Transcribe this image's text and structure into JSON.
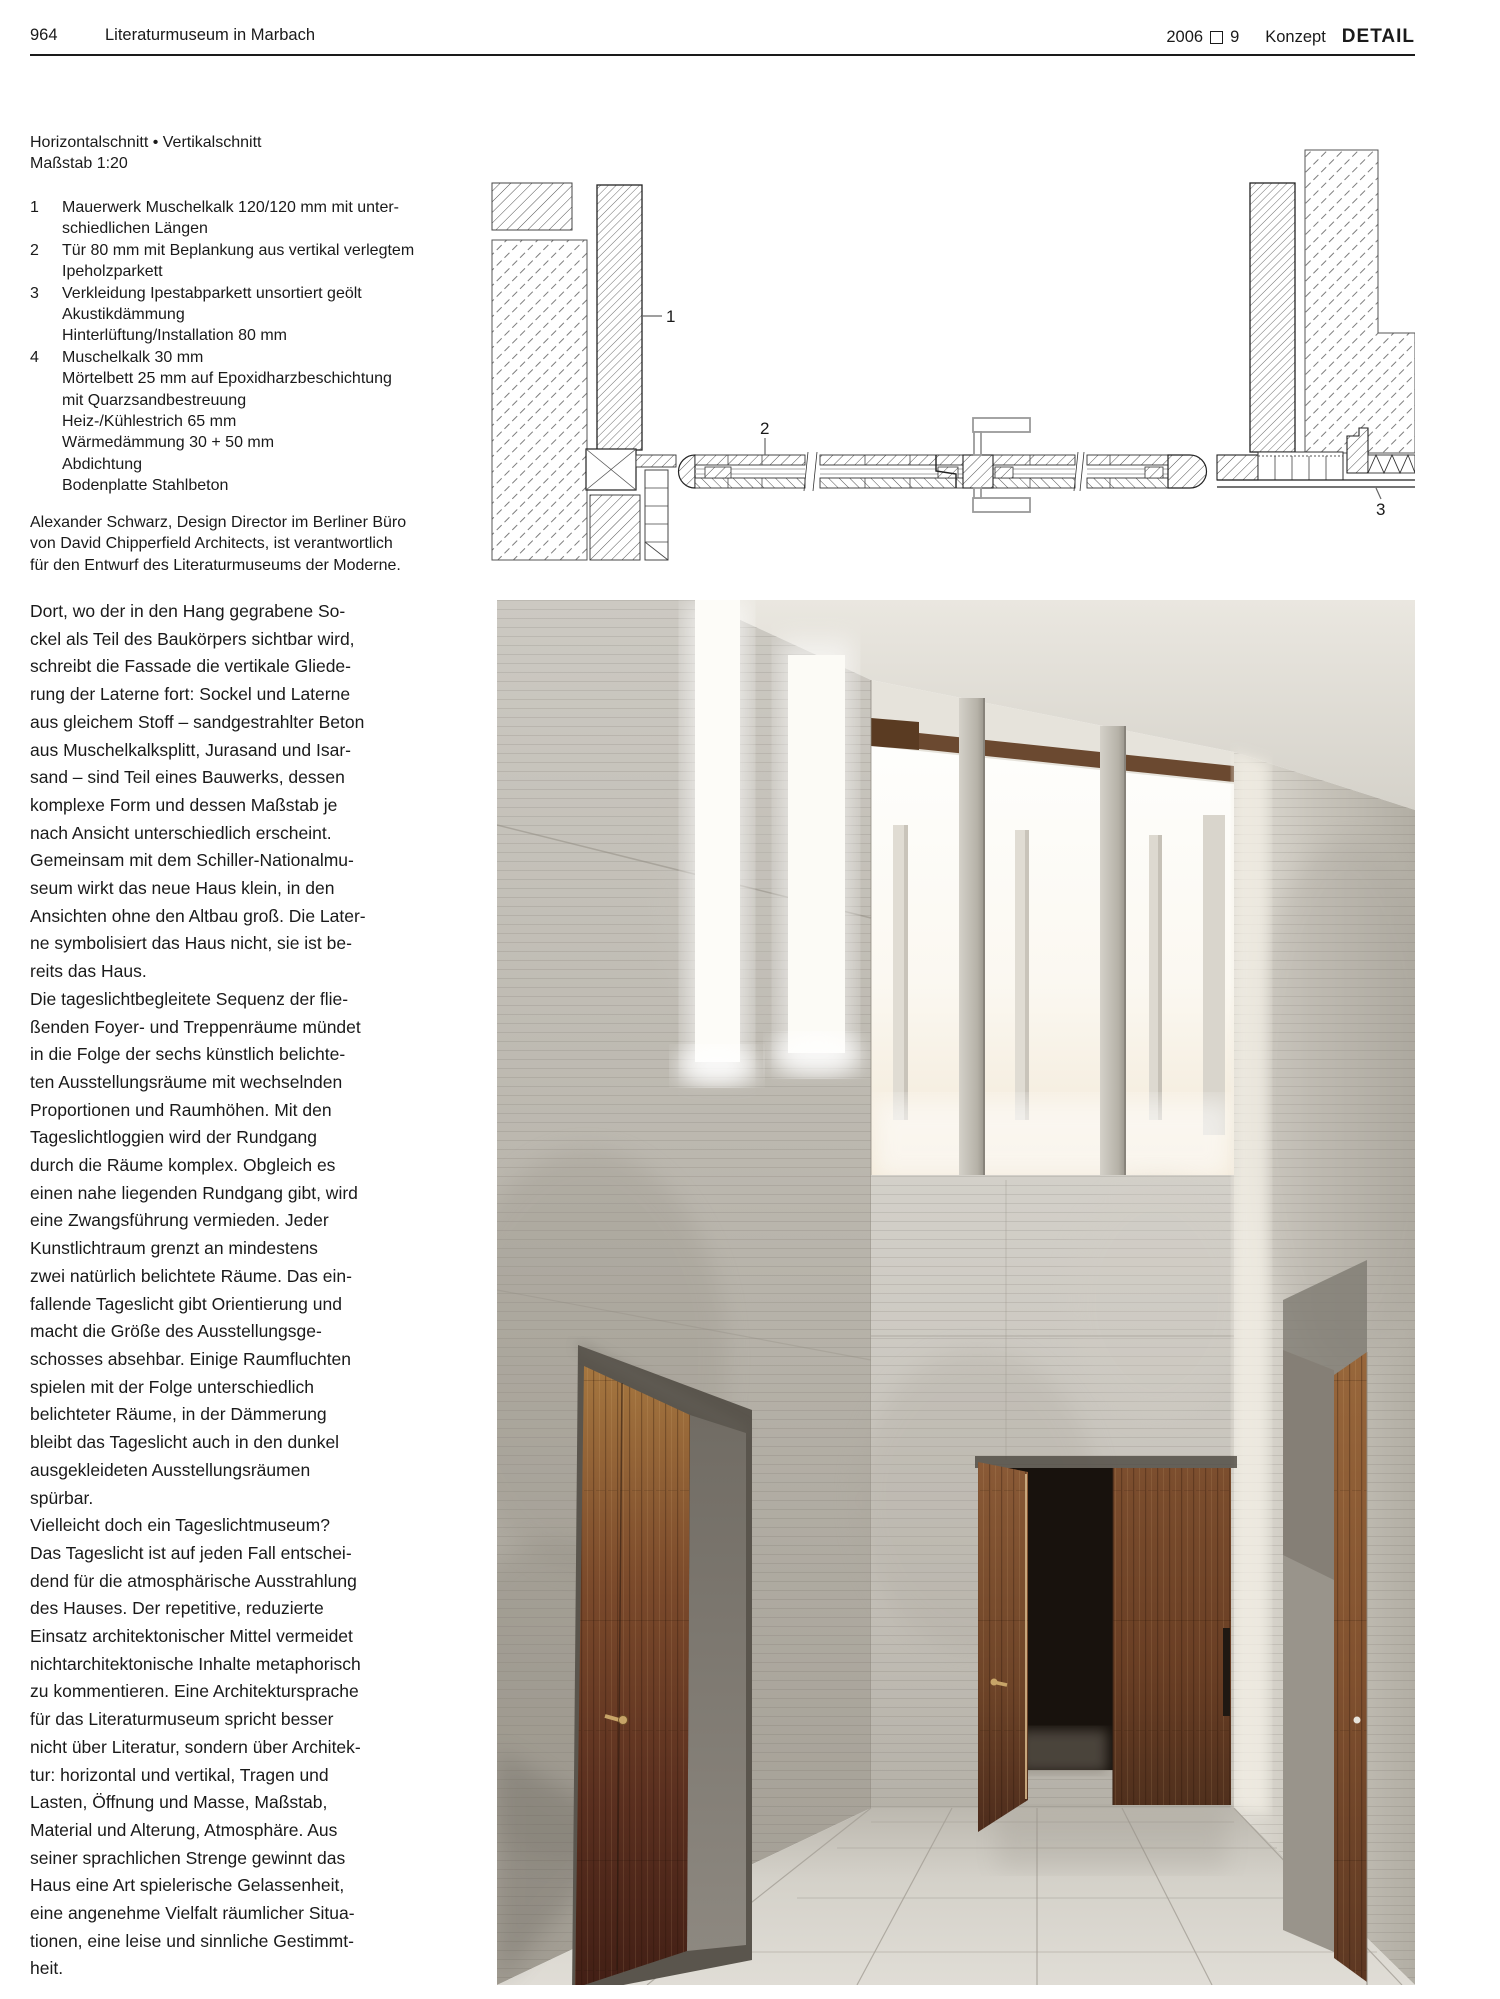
{
  "header": {
    "page_number": "964",
    "title": "Literaturmuseum in Marbach",
    "year": "2006",
    "issue": "9",
    "section": "Konzept",
    "brand": "DETAIL",
    "issue_box_icon": "open-square"
  },
  "drawing": {
    "caption": [
      "Horizontalschnitt • Vertikalschnitt",
      "Maßstab  1:20"
    ],
    "legend": [
      {
        "num": "1",
        "lines": [
          "Mauerwerk Muschelkalk 120/120 mm mit unter-",
          "schiedlichen Längen"
        ]
      },
      {
        "num": "2",
        "lines": [
          "Tür 80 mm mit Beplankung aus vertikal verlegtem",
          "Ipeholzparkett"
        ]
      },
      {
        "num": "3",
        "lines": [
          "Verkleidung Ipestabparkett unsortiert geölt",
          "Akustikdämmung",
          "Hinterlüftung/Installation 80 mm"
        ]
      },
      {
        "num": "4",
        "lines": [
          "Muschelkalk 30 mm",
          "Mörtelbett 25 mm auf Epoxidharzbeschichtung",
          "mit Quarzsandbestreuung",
          "Heiz-/Kühlestrich 65 mm",
          "Wärmedämmung 30 + 50 mm",
          "Abdichtung",
          "Bodenplatte Stahlbeton"
        ]
      }
    ],
    "labels": [
      "1",
      "2",
      "3"
    ]
  },
  "credit": [
    "Alexander Schwarz, Design Director im Berliner Büro",
    "von David Chipperfield Architects, ist verantwortlich",
    "für den Entwurf des Literaturmuseums der Moderne."
  ],
  "article": {
    "paragraphs": [
      [
        "Dort, wo der in den Hang gegrabene So-",
        "ckel als Teil des Baukörpers sichtbar wird,",
        "schreibt die Fassade die vertikale Gliede-",
        "rung der Laterne fort: Sockel und Laterne",
        "aus gleichem Stoff – sandgestrahlter Beton",
        "aus Muschelkalksplitt, Jurasand und Isar-",
        "sand – sind Teil eines Bauwerks, dessen",
        "komplexe Form und dessen Maßstab je",
        "nach Ansicht unterschiedlich erscheint.",
        "Gemeinsam mit dem Schiller-Nationalmu-",
        "seum wirkt das neue Haus klein, in den",
        "Ansichten ohne den Altbau groß. Die Later-",
        "ne symbolisiert das Haus nicht, sie ist be-",
        "reits das Haus."
      ],
      [
        "Die tageslichtbegleitete Sequenz der flie-",
        "ßenden Foyer- und Treppenräume mündet",
        "in die Folge der sechs künstlich belichte-",
        "ten Ausstellungsräume mit wechselnden",
        "Proportionen und Raumhöhen. Mit den",
        "Tageslichtloggien wird der Rundgang",
        "durch die Räume komplex. Obgleich es",
        "einen nahe liegenden Rundgang gibt, wird",
        "eine Zwangsführung vermieden. Jeder",
        "Kunstlichtraum grenzt an mindestens",
        "zwei natürlich belichtete Räume. Das ein-",
        "fallende Tageslicht gibt Orientierung und",
        "macht die Größe des Ausstellungsge-",
        "schosses absehbar. Einige Raumfluchten",
        "spielen mit der Folge unterschiedlich",
        "belichteter Räume, in der Dämmerung",
        "bleibt das Tageslicht auch in den dunkel",
        "ausgekleideten Ausstellungsräumen",
        "spürbar."
      ],
      [
        "Vielleicht doch ein Tageslichtmuseum?",
        "Das Tageslicht ist auf jeden Fall entschei-",
        "dend für die atmosphärische Ausstrahlung",
        "des Hauses. Der repetitive, reduzierte",
        "Einsatz architektonischer Mittel vermeidet",
        "nichtarchitektonische Inhalte metaphorisch",
        "zu kommentieren. Eine Architektursprache",
        "für das Literaturmuseum spricht besser",
        "nicht über Literatur, sondern über Architek-",
        "tur: horizontal und vertikal, Tragen und",
        "Lasten, Öffnung und Masse, Maßstab,",
        "Material und Alterung, Atmosphäre. Aus",
        "seiner sprachlichen Strenge gewinnt das",
        "Haus eine Art spielerische Gelassenheit,",
        "eine angenehme Vielfalt räumlicher Situa-",
        "tionen, eine leise und sinnliche Gestimmt-",
        "heit."
      ]
    ]
  }
}
